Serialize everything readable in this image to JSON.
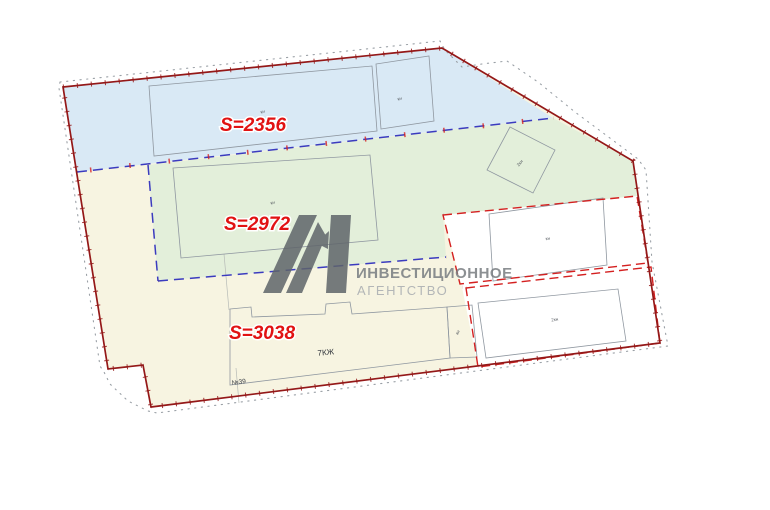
{
  "map": {
    "title": "site-plan-with-land-areas",
    "area_labels": [
      {
        "id": "north-blue-zone",
        "text": "S=2356"
      },
      {
        "id": "middle-green-zone",
        "text": "S=2972"
      },
      {
        "id": "south-cream-zone",
        "text": "S=3038"
      }
    ],
    "building_labels": {
      "blue_main": "кн",
      "blue_small": "кн",
      "green_main": "кн",
      "green_square": "2кн",
      "parcel_upper": "кн",
      "parcel_lower": "2кн",
      "annex": "кн",
      "residential": "7КЖ",
      "house_number": "№39"
    },
    "colors": {
      "zone_blue": "#d9e9f5",
      "zone_green": "#e3efda",
      "zone_cream": "#f7f4e1",
      "parcel_white": "#ffffff",
      "boundary_red": "#941818",
      "dashed_blue": "#3b3bbf",
      "dashed_red": "#d42020",
      "dotted_gray": "#9aa0a6",
      "building_outline": "#8f97a0",
      "area_label_red": "#e11212"
    }
  },
  "watermark": {
    "line1": "ИНВЕСТИЦИОННОЕ",
    "line2": "АГЕНТСТВО",
    "mark_color": "#5f656a",
    "text_color": "#787d81",
    "text_light_color": "#a8acb0"
  }
}
